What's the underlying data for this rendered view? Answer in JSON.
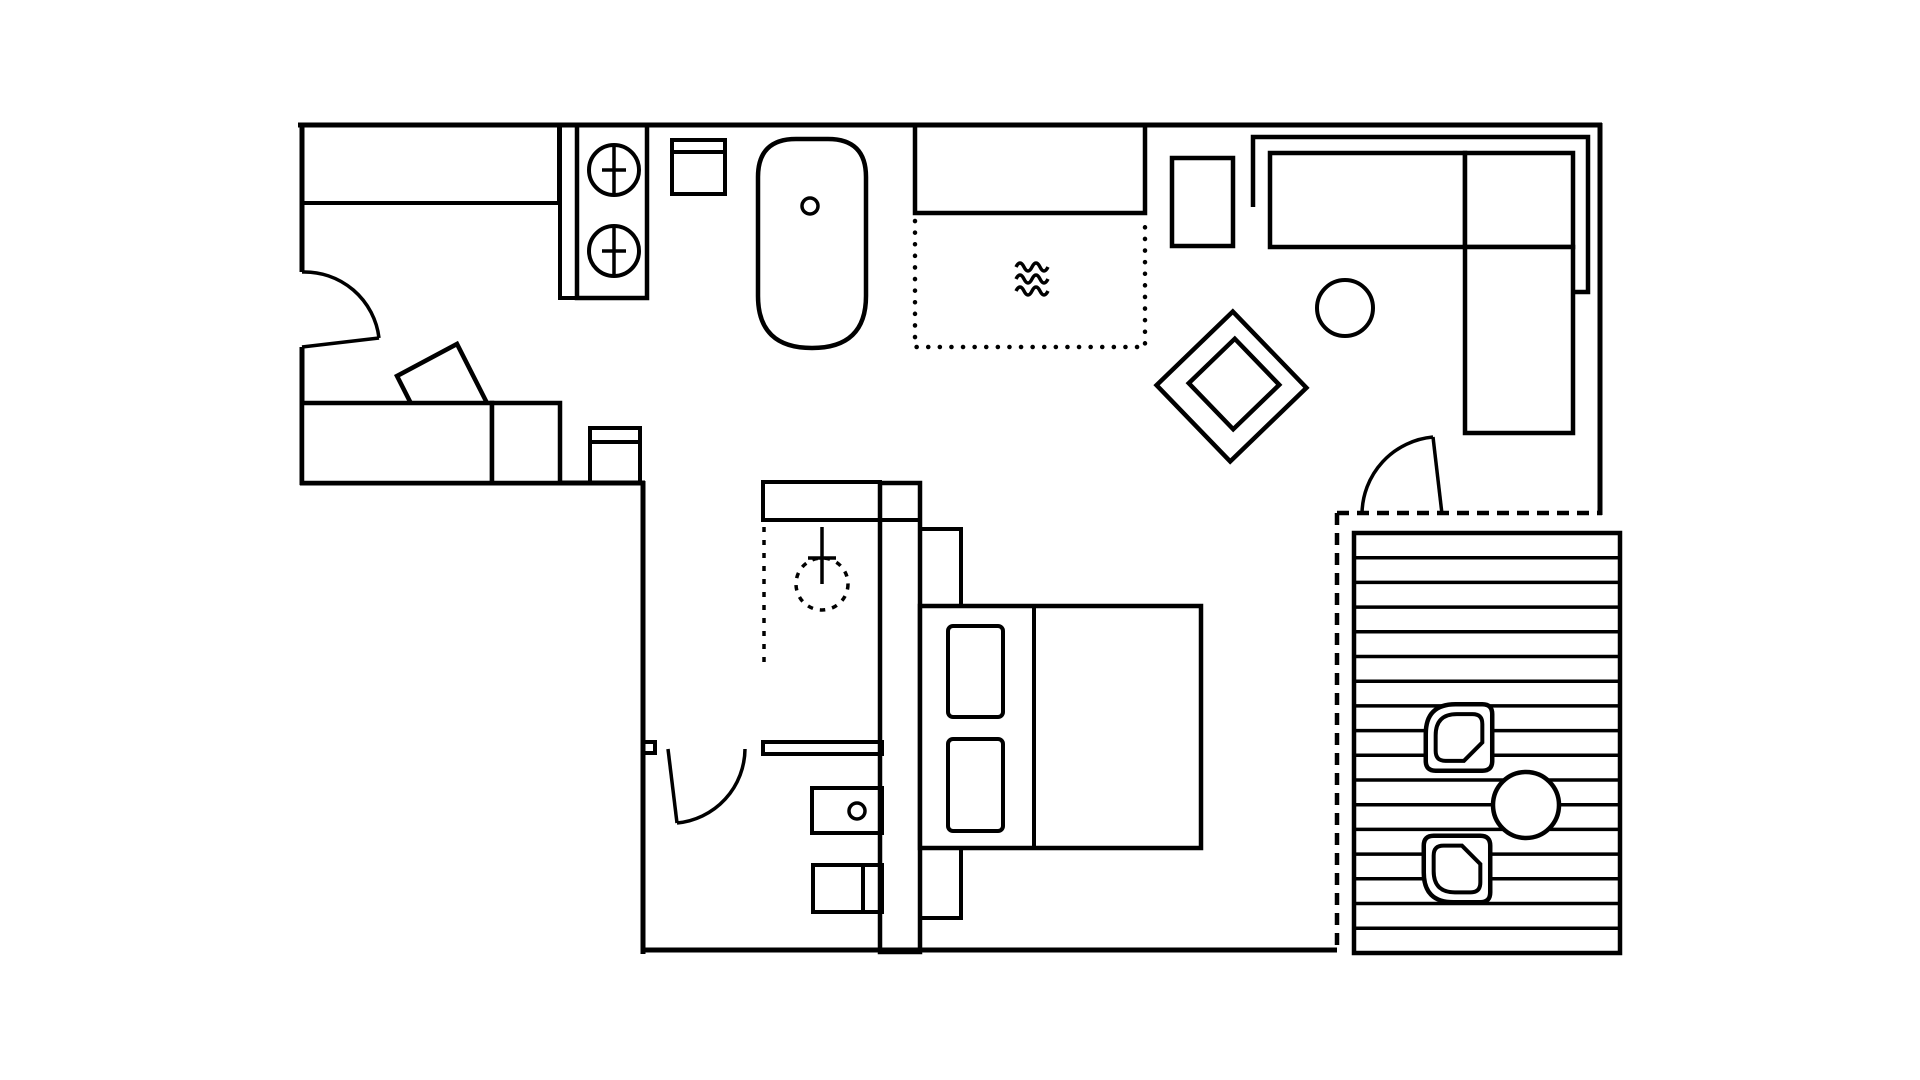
{
  "meta": {
    "description": "black-and-white architectural floor plan of a studio apartment with deck",
    "background_color": "#ffffff",
    "line_color": "#000000"
  },
  "plan": {
    "entry_room": {
      "symbols": [
        "hinged-door",
        "wardrobe-counter",
        "accent-chair",
        "daybed-sofa",
        "sofa-cushion",
        "corner-cabinet"
      ]
    },
    "kitchen": {
      "symbols": [
        "counter-strip",
        "cooktop-unit",
        "burner",
        "burner",
        "wall-cabinet"
      ],
      "burner_count": 2
    },
    "bathroom": {
      "symbols": [
        "bathtub",
        "tub-drain",
        "shower-head",
        "shower-screen-dashed",
        "storage-shelf",
        "hinged-door",
        "vanity-cabinet",
        "sink-knob",
        "divided-cabinet"
      ]
    },
    "living_room": {
      "symbols": [
        "media-cabinet",
        "dotted-rug",
        "floor-heating-waves",
        "side-table",
        "sectional-sofa",
        "sofa-back-frame",
        "coffee-table",
        "rotated-armchair",
        "hinged-door",
        "glass-wall-dashed"
      ]
    },
    "bedroom": {
      "symbols": [
        "headboard-nightstand",
        "double-bed",
        "pillow",
        "pillow",
        "mattress-divider",
        "foot-bench"
      ],
      "pillow_count": 2
    },
    "deck": {
      "symbols": [
        "plank-decking",
        "deck-chair",
        "deck-chair",
        "round-deck-table"
      ],
      "plank_line_count": 16,
      "chair_count": 2
    }
  }
}
